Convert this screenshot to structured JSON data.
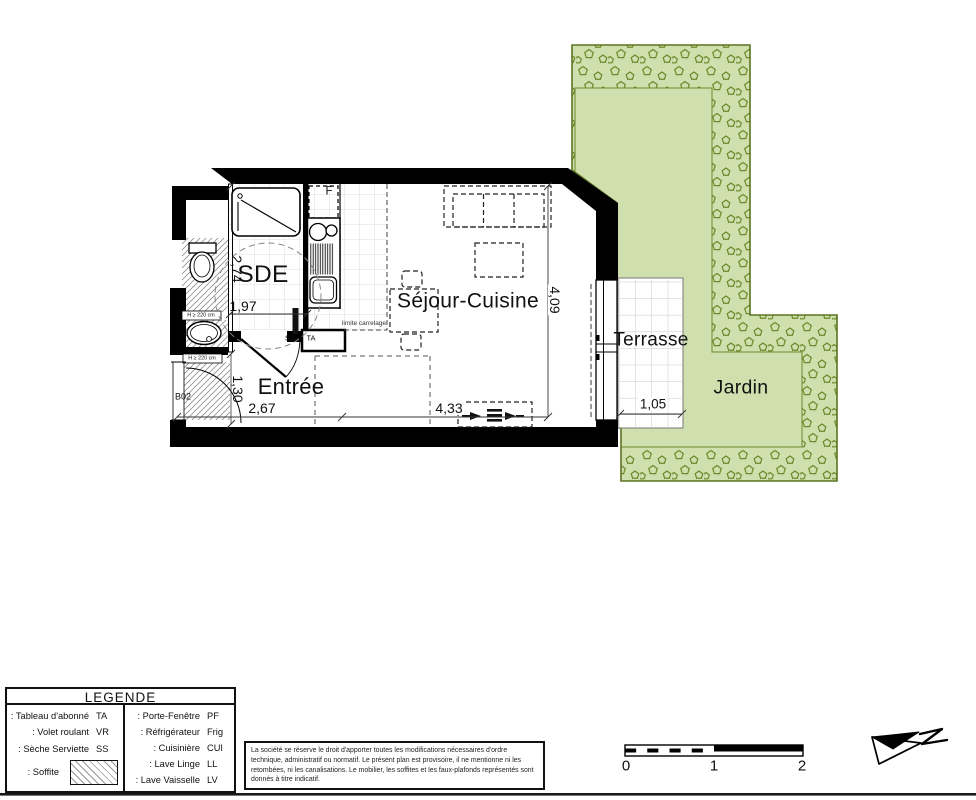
{
  "plan": {
    "room_labels": {
      "sde": "SDE",
      "entree": "Entrée",
      "sejour": "Séjour-Cuisine",
      "terrasse": "Terrasse",
      "jardin": "Jardin"
    },
    "annotations": {
      "door_code": "B02",
      "fridge": "F",
      "towel_dryer": "SS",
      "panel": "TA",
      "tile_limit": "limite carrelage",
      "height_note": "H ≥ 220 cm"
    },
    "dims": {
      "d274": "2,74",
      "d197": "1,97",
      "d130": "1,30",
      "d267": "2,67",
      "d433": "4,33",
      "d409": "4,09",
      "d105": "1,05"
    }
  },
  "legend": {
    "title": "LEGENDE",
    "left": [
      {
        "label": ": Tableau d'abonné",
        "abbr": "TA"
      },
      {
        "label": ": Volet roulant",
        "abbr": "VR"
      },
      {
        "label": ": Sèche Serviette",
        "abbr": "SS"
      },
      {
        "label": ": Soffite",
        "abbr": ""
      }
    ],
    "right": [
      {
        "label": ": Porte-Fenêtre",
        "abbr": "PF"
      },
      {
        "label": ": Réfrigérateur",
        "abbr": "Frig"
      },
      {
        "label": ": Cuisinière",
        "abbr": "CUI"
      },
      {
        "label": ": Lave Linge",
        "abbr": "LL"
      },
      {
        "label": ": Lave Vaisselle",
        "abbr": "LV"
      }
    ]
  },
  "disclaimer": "La société se réserve le droit d'apporter toutes les modifications nécessaires d'ordre technique, administratif ou normatif. Le présent plan est provisoire, il ne mentionne ni les retombées, ni les canalisations. Le mobilier, les soffites et les faux-plafonds représentés sont donnés à titre indicatif.",
  "scalebar": {
    "t0": "0",
    "t1": "1",
    "t2": "2"
  },
  "colors": {
    "garden_fill": "#cfdfad",
    "garden_stroke": "#5c7521",
    "shrub_stroke": "#6d882b",
    "wall": "#000000"
  }
}
